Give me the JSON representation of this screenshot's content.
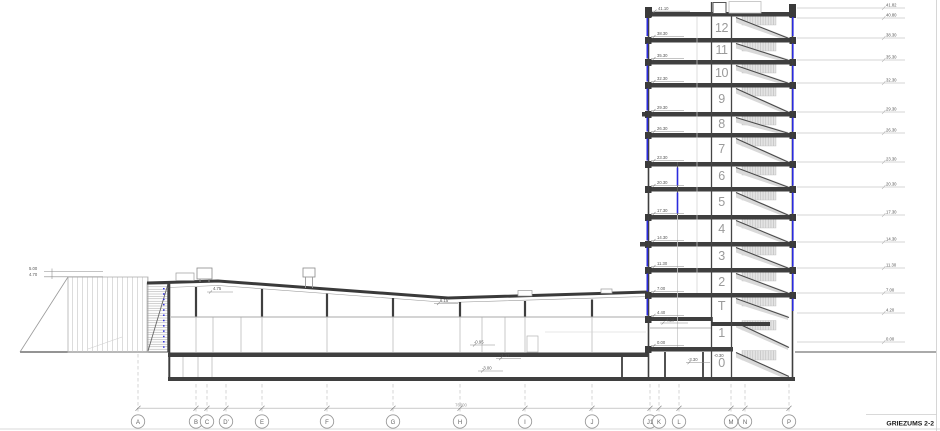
{
  "drawing": {
    "title": "GRIEZUMS 2-2"
  },
  "colors": {
    "glazing_blue": "#2b2bdd",
    "wall_dark": "#3f3f3f"
  },
  "tower": {
    "roof_elevation": "41.10",
    "landing_elevation": "4.20",
    "pit_elevation": "-0.30",
    "floors": [
      {
        "label": "12",
        "elevation": "38.30"
      },
      {
        "label": "11",
        "elevation": "35.30"
      },
      {
        "label": "10",
        "elevation": "32.30"
      },
      {
        "label": "9",
        "elevation": "29.30"
      },
      {
        "label": "8",
        "elevation": "26.30"
      },
      {
        "label": "7",
        "elevation": "23.30"
      },
      {
        "label": "6",
        "elevation": "20.30"
      },
      {
        "label": "5",
        "elevation": "17.30"
      },
      {
        "label": "4",
        "elevation": "14.30"
      },
      {
        "label": "3",
        "elevation": "11.30"
      },
      {
        "label": "2",
        "elevation": "7.00"
      },
      {
        "label": "T",
        "elevation": "4.40"
      },
      {
        "label": "1",
        "elevation": "0.00"
      },
      {
        "label": "0",
        "elevation": "-3.30"
      }
    ]
  },
  "right_elevations": [
    "41.82",
    "40.80",
    "38.30",
    "35.30",
    "32.30",
    "29.30",
    "26.30",
    "23.30",
    "20.30",
    "17.30",
    "14.30",
    "11.30",
    "7.00",
    "4.20",
    "0.00"
  ],
  "annex_elevations": [
    "5.00",
    "4.70"
  ],
  "hall_elevations": [
    "4.75",
    "6.15",
    "-0.95",
    "-1.17",
    "-3.00"
  ],
  "grid": {
    "letters": [
      "A",
      "B",
      "C",
      "D'",
      "E",
      "F",
      "G",
      "H",
      "I",
      "J",
      "J1",
      "K",
      "L",
      "M",
      "N",
      "P"
    ],
    "overall_dimension": "76000"
  }
}
